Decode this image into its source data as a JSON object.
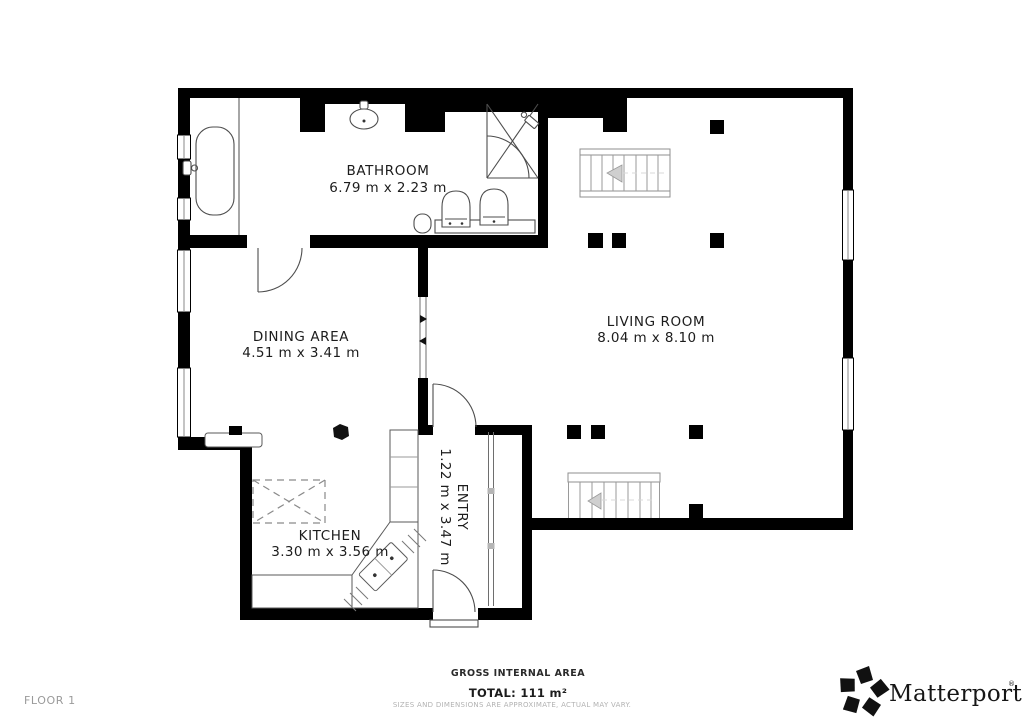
{
  "page": {
    "floor_label": "FLOOR 1"
  },
  "rooms": {
    "bathroom": {
      "name": "BATHROOM",
      "dims": "6.79 m x 2.23 m"
    },
    "dining": {
      "name": "DINING AREA",
      "dims": "4.51 m x 3.41 m"
    },
    "living": {
      "name": "LIVING ROOM",
      "dims": "8.04 m x 8.10 m"
    },
    "kitchen": {
      "name": "KITCHEN",
      "dims": "3.30 m x 3.56 m"
    },
    "entry": {
      "name": "ENTRY",
      "dims": "1.22 m x 3.47 m"
    }
  },
  "footer": {
    "gross_area_label": "GROSS INTERNAL AREA",
    "total_label": "TOTAL: 111 m²",
    "disclaimer": "SIZES AND DIMENSIONS ARE APPROXIMATE, ACTUAL MAY VARY."
  },
  "branding": {
    "logo_text": "Matterport",
    "trademark": "®",
    "logo_icon": "matterport-pinwheel-icon"
  },
  "colors": {
    "wall": "#000000",
    "fixture_line": "#4d4d4d",
    "stair_line": "#8f8f8f",
    "arrow_fill": "#cfcfcf",
    "label_text": "#1c1c1c",
    "muted_text": "#9a9a9a",
    "disclaimer_text": "#b2b2b2"
  }
}
